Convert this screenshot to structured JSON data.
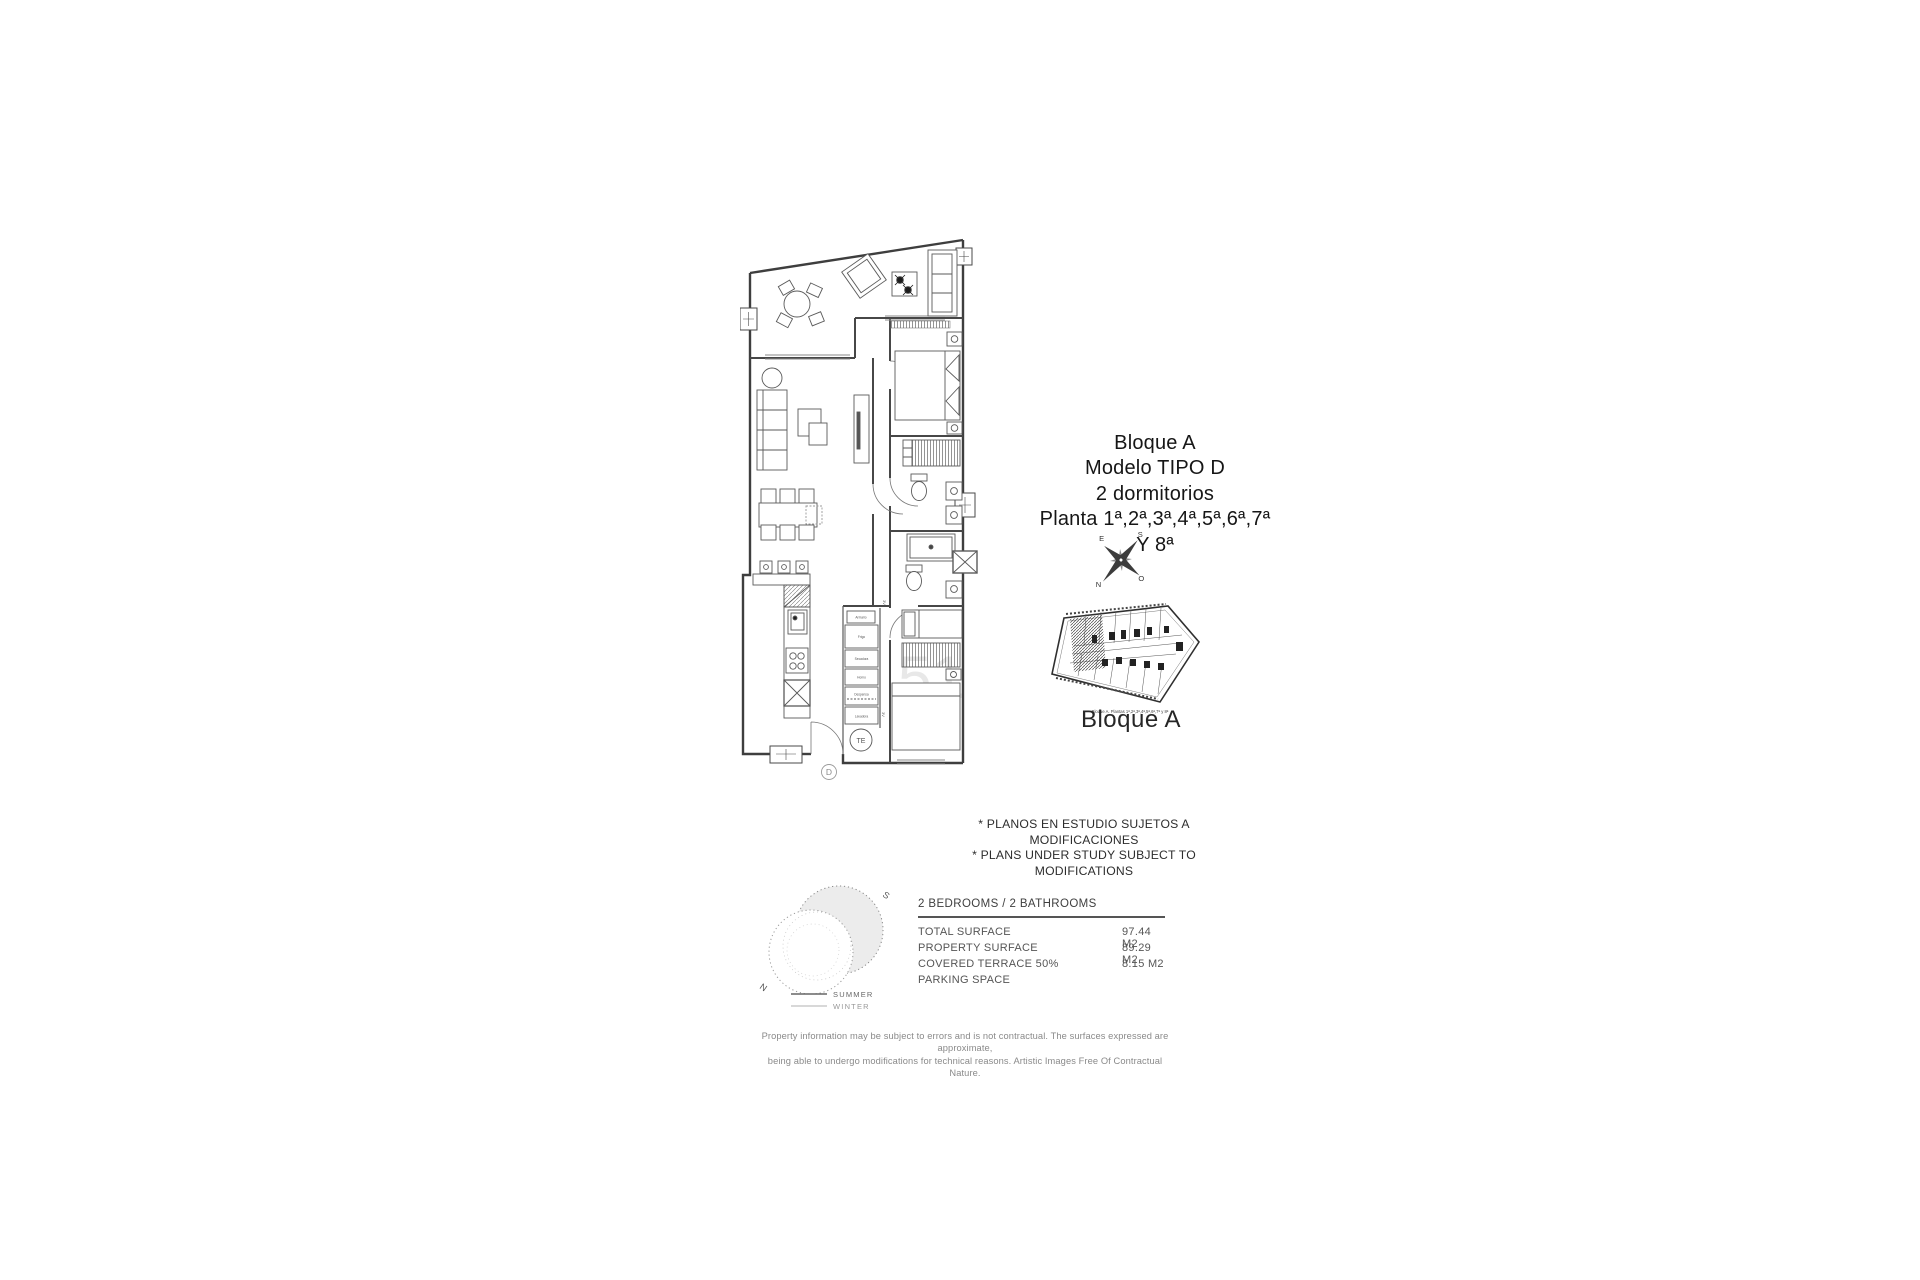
{
  "title_block": {
    "line1": "Bloque A",
    "line2": "Modelo TIPO D",
    "line3": "2 dormitorios",
    "line4": "Planta 1ª,2ª,3ª,4ª,5ª,6ª,7ª Y 8ª"
  },
  "compass": {
    "north": "N",
    "south": "S",
    "east": "E",
    "west": "O"
  },
  "key_plan": {
    "caption": "Bloque A. Plantas 1ª,2ª,3ª,4ª,5ª,6ª,7ª y 8ª",
    "label": "Bloque A"
  },
  "floor_plan": {
    "unit_letter": "D",
    "heater_label": "TE",
    "door_tag": "3V",
    "watermark": "51",
    "utility_labels": [
      "Armario",
      "Frigo",
      "Secadora",
      "Horno",
      "Despensa",
      "Lavadora"
    ]
  },
  "notes": {
    "line1": "* PLANOS EN ESTUDIO SUJETOS A MODIFICACIONES",
    "line2": "* PLANS UNDER STUDY SUBJECT TO MODIFICATIONS"
  },
  "sun_diagram": {
    "south": "S",
    "north": "N",
    "legend": [
      {
        "label": "SUMMER"
      },
      {
        "label": "WINTER"
      }
    ]
  },
  "specs": {
    "header": "2 BEDROOMS / 2 BATHROOMS",
    "rows": [
      {
        "label": "TOTAL SURFACE",
        "value": "97.44 M2"
      },
      {
        "label": "PROPERTY SURFACE",
        "value": "89.29 M2"
      },
      {
        "label": "COVERED TERRACE 50%",
        "value": "8.15 M2"
      },
      {
        "label": "PARKING SPACE",
        "value": ""
      }
    ]
  },
  "disclaimer": {
    "line1": "Property information may be subject to errors and is not contractual. The surfaces expressed are approximate,",
    "line2": "being able to undergo modifications for technical reasons. Artistic Images Free Of Contractual Nature."
  },
  "colors": {
    "line": "#4a4a4a",
    "text": "#333333",
    "muted": "#8a8a8a",
    "shade": "#ececec"
  }
}
